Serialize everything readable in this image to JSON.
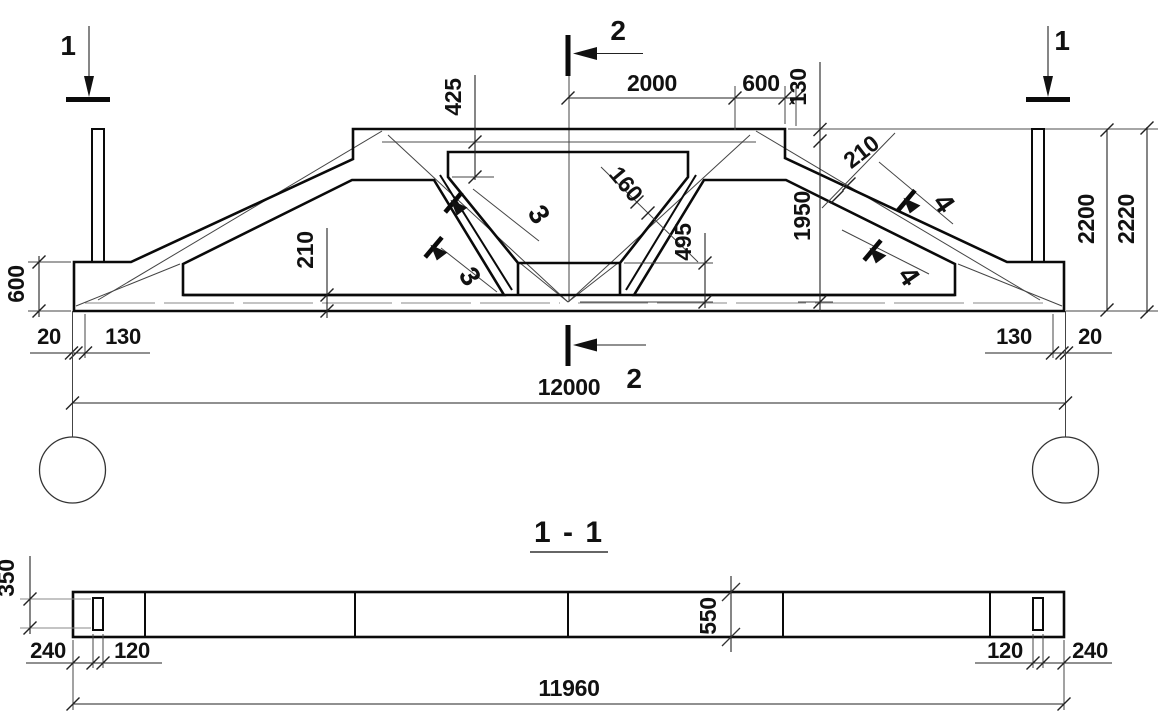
{
  "drawing": {
    "kind": "truss elevation with section",
    "section_title": "1 - 1",
    "marks": {
      "section_1": "1",
      "section_2": "2",
      "detail_3": "3",
      "detail_4": "4"
    },
    "elevation_dims": {
      "top_2000": "2000",
      "top_600": "600",
      "top_130": "130",
      "v_425": "425",
      "v_1950": "1950",
      "v_2200": "2200",
      "v_2220": "2220",
      "left_600": "600",
      "chord_210": "210",
      "slope_210": "210",
      "web_160": "160",
      "node_495": "495",
      "bottom_left_20": "20",
      "bottom_left_130": "130",
      "bottom_right_130": "130",
      "bottom_right_20": "20",
      "span_12000": "12000"
    },
    "section_dims": {
      "v_350": "350",
      "v_550": "550",
      "left_240": "240",
      "left_120": "120",
      "right_120": "120",
      "right_240": "240",
      "length_11960": "11960"
    },
    "colors": {
      "line": "#0a0a0a",
      "axis_gray": "#9a9a9a",
      "background": "#ffffff"
    }
  }
}
